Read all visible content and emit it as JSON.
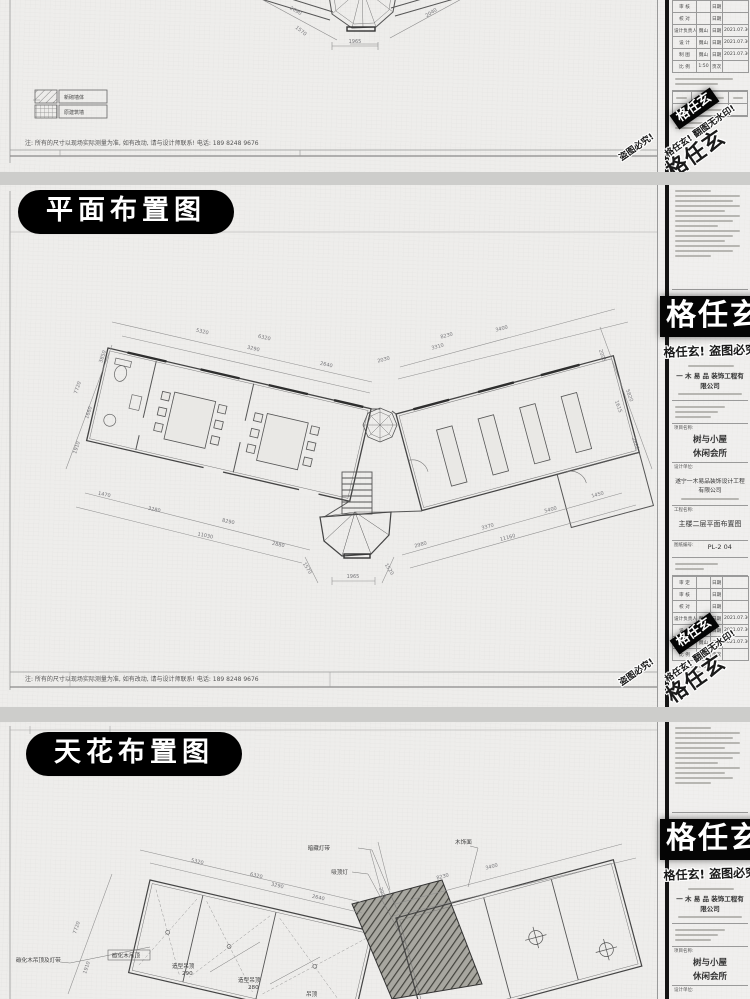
{
  "brand": {
    "name": "格任玄",
    "warn_combo": "格任玄! 盗图必究!",
    "warn_piracy": "盗图必究!",
    "warn_nowm": "格任玄! 翻图无水印!"
  },
  "sheet_note": "注: 所有的尺寸以现场实际测量为准, 如有改动, 请与设计师联系! 电话: 189 8248 9676",
  "panel_top": {
    "dims": [
      "2690",
      "2040",
      "1570",
      "1965"
    ],
    "legend": [
      "新砌墙体",
      "原建筑墙"
    ]
  },
  "panel_plan": {
    "title": "平面布置图",
    "dims": [
      "5320",
      "6320",
      "3290",
      "2640",
      "2030",
      "8230",
      "3400",
      "3310",
      "2005",
      "5820",
      "1615",
      "2880",
      "3850",
      "7720",
      "1660",
      "1910",
      "1470",
      "3280",
      "8290",
      "11030",
      "2880",
      "1570",
      "1965",
      "1520",
      "2980",
      "3370",
      "11160",
      "5400",
      "1450"
    ]
  },
  "panel_ceiling": {
    "title": "天花布置图",
    "dims": [
      "5320",
      "6320",
      "3290",
      "2640",
      "2005",
      "8230",
      "3400",
      "7720",
      "1910"
    ],
    "callouts": [
      "暗藏灯带",
      "吸顶灯",
      "木饰面",
      "碳化木吊顶及灯带",
      "碳化木吊顶",
      "造型吊顶",
      "290",
      "造型吊顶",
      "280",
      "吊顶"
    ]
  },
  "titleblock": {
    "company_cn": "一 木 易 品  装饰工程有限公司",
    "project_label": "项目名称:",
    "project_name_line1": "树与小屋",
    "project_name_line2": "休闲会所",
    "design_label": "设计单位:",
    "design_unit": "遂宁一木易品装饰设计工程有限公司",
    "drawing_label": "工程名称:",
    "drawing_name": "主楼二层平面布置图",
    "no_label": "图纸编号:",
    "drawing_no": "PL-2 04",
    "rows": [
      {
        "k": "审 定",
        "v": "",
        "dl": "日期",
        "dv": ""
      },
      {
        "k": "审 核",
        "v": "",
        "dl": "日期",
        "dv": ""
      },
      {
        "k": "校 对",
        "v": "",
        "dl": "日期",
        "dv": ""
      },
      {
        "k": "设计负责人",
        "v": "魏山",
        "dl": "日期",
        "dv": "2021.07.30"
      },
      {
        "k": "设 计",
        "v": "魏山",
        "dl": "日期",
        "dv": "2021.07.30"
      },
      {
        "k": "制 图",
        "v": "魏山",
        "dl": "日期",
        "dv": "2021.07.30"
      },
      {
        "k": "比 例",
        "v": "1:50",
        "dl": "页次",
        "dv": ""
      }
    ]
  }
}
